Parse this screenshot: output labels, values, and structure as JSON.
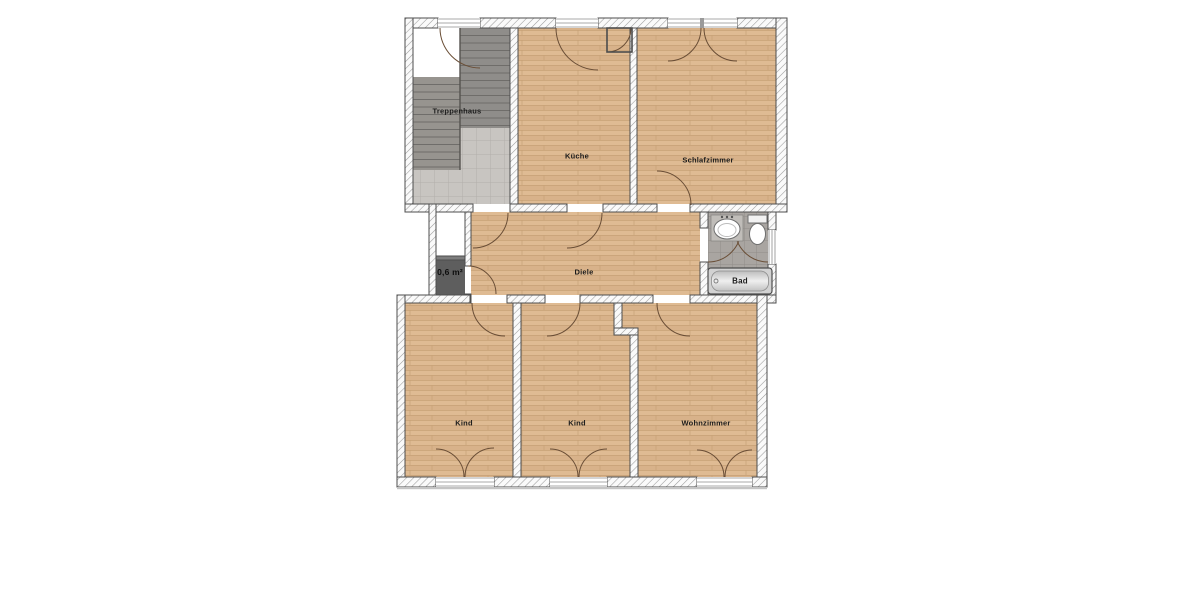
{
  "floorplan": {
    "type": "apartment-floorplan",
    "language": "de",
    "rooms": {
      "treppenhaus": {
        "label": "Treppenhaus"
      },
      "kueche": {
        "label": "Küche"
      },
      "schlafzimmer": {
        "label": "Schlafzimmer"
      },
      "diele": {
        "label": "Diele"
      },
      "abstellraum": {
        "label": "0,6 m²"
      },
      "bad": {
        "label": "Bad"
      },
      "kind_links": {
        "label": "Kind"
      },
      "kind_mitte": {
        "label": "Kind"
      },
      "wohnzimmer": {
        "label": "Wohnzimmer"
      }
    },
    "fixtures": [
      "stairs",
      "bathtub",
      "sink",
      "toilet"
    ],
    "colors": {
      "wood_floor": "#dcb68e",
      "tile_floor_bath": "#a9a5a1",
      "tile_floor_stair": "#c8c5c1",
      "stairs": "#8f8d8a",
      "shaft_dark": "#5e5e5e",
      "wall_outline": "#4d4d4d",
      "door_swing": "#6a4e36",
      "label_text": "#1b1b1b"
    }
  }
}
